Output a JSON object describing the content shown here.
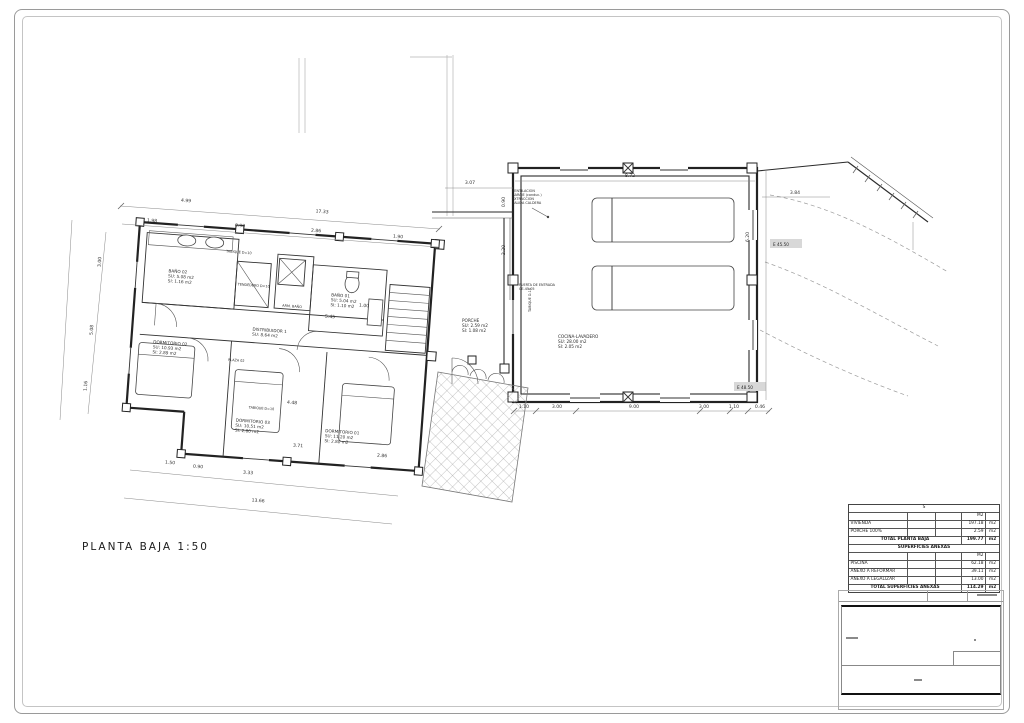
{
  "page": {
    "plan_title": "PLANTA BAJA  1:50"
  },
  "plan": {
    "rooms": {
      "bano02": {
        "name": "BAÑO 02",
        "l1": "SU: 5.08 m2",
        "l2": "SI: 1.16 m2"
      },
      "bano01": {
        "name": "BAÑO 01",
        "l1": "SU: 5.04 m2",
        "l2": "SI: 1.10 m2"
      },
      "distribuidor": {
        "name": "DISTRIBUIDOR 1",
        "l1": "SU: 8.64 m2",
        "l2": ""
      },
      "dorm02": {
        "name": "DORMITORIO 02",
        "l1": "SU: 10.93 m2",
        "l2": "SI: 2.89 m2"
      },
      "dorm03": {
        "name": "DORMITORIO 03",
        "l1": "SU: 10.51 m2",
        "l2": "SI: 2.80 m2"
      },
      "dorm01": {
        "name": "DORMITORIO 01",
        "l1": "SU: 11.20 m2",
        "l2": "SI: 2.80 m2"
      },
      "cocina": {
        "name": "COCINA-LAVADERO",
        "l1": "SU: 28.00 m2",
        "l2": "SI: 2.05 m2"
      },
      "porche": {
        "name": "PORCHE",
        "l1": "SU: 2.59 m2",
        "l2": "SI: 1.08 m2"
      }
    },
    "notes": {
      "plaza": "PLAZA 02",
      "tendedero": "TENDEDERO D=10",
      "tabique_a": "TABIQUE D=10",
      "tabique_b": "TABIQUE D=10",
      "tabique_c": "TABIQUE D-10",
      "armario": "ARM. BAÑO",
      "ventilacion": [
        "VENTILACION",
        "GARAJE (conduc.)",
        "EXTRACCION",
        "SALIDA CALDERA"
      ],
      "puerta": [
        "PUERTA DE ENTRADA",
        "CE-45-05"
      ],
      "elev_a": "E 45.50",
      "elev_b": "E 48.50"
    }
  },
  "dimensions": [
    {
      "t": "4.99",
      "x": 186,
      "y": 202,
      "r": 4
    },
    {
      "t": "17.33",
      "x": 322,
      "y": 213,
      "r": 4
    },
    {
      "t": "1.98",
      "x": 152,
      "y": 222,
      "r": 4
    },
    {
      "t": "0.90",
      "x": 240,
      "y": 227,
      "r": 4
    },
    {
      "t": "2.86",
      "x": 316,
      "y": 232,
      "r": 4
    },
    {
      "t": "1.90",
      "x": 398,
      "y": 238,
      "r": 4
    },
    {
      "t": "3.07",
      "x": 470,
      "y": 184,
      "r": 0
    },
    {
      "t": "8.72",
      "x": 630,
      "y": 177,
      "r": 0
    },
    {
      "t": "3.84",
      "x": 795,
      "y": 194,
      "r": 0
    },
    {
      "t": "6.20",
      "x": 749,
      "y": 237,
      "r": -90
    },
    {
      "t": "1.10",
      "x": 524,
      "y": 408,
      "r": 0
    },
    {
      "t": "3.00",
      "x": 557,
      "y": 408,
      "r": 0
    },
    {
      "t": "9.00",
      "x": 634,
      "y": 408,
      "r": 0
    },
    {
      "t": "3.00",
      "x": 704,
      "y": 408,
      "r": 0
    },
    {
      "t": "1.10",
      "x": 734,
      "y": 408,
      "r": 0
    },
    {
      "t": "0.46",
      "x": 760,
      "y": 408,
      "r": 0
    },
    {
      "t": "0.90",
      "x": 505,
      "y": 202,
      "r": -90
    },
    {
      "t": "2.20",
      "x": 505,
      "y": 250,
      "r": -90
    },
    {
      "t": "3.00",
      "x": 101,
      "y": 262,
      "r": -86
    },
    {
      "t": "5.08",
      "x": 93,
      "y": 330,
      "r": -86
    },
    {
      "t": "1.16",
      "x": 87,
      "y": 386,
      "r": -86
    },
    {
      "t": "5.45",
      "x": 330,
      "y": 318,
      "r": 4
    },
    {
      "t": "1.00",
      "x": 364,
      "y": 307,
      "r": 4
    },
    {
      "t": "4.48",
      "x": 292,
      "y": 404,
      "r": 4
    },
    {
      "t": "3.71",
      "x": 298,
      "y": 447,
      "r": 4
    },
    {
      "t": "2.86",
      "x": 382,
      "y": 457,
      "r": 4
    },
    {
      "t": "1.50",
      "x": 170,
      "y": 464,
      "r": 4
    },
    {
      "t": "0.90",
      "x": 198,
      "y": 468,
      "r": 4
    },
    {
      "t": "3.33",
      "x": 248,
      "y": 474,
      "r": 4
    },
    {
      "t": "13.66",
      "x": 258,
      "y": 502,
      "r": 4
    }
  ],
  "surfaces_table": {
    "header_s": "S",
    "m2": "M2",
    "unit": "m2",
    "rows": {
      "vivienda": {
        "label": "VIVIENDA",
        "value": "197.18"
      },
      "porche": {
        "label": "PORCHE 100%",
        "value": "2.59"
      },
      "total_pb": {
        "label": "TOTAL PLANTA BAJA",
        "value": "199.77"
      },
      "anexas_hdr": "SUPERFICIES ANEXAS",
      "piscina": {
        "label": "PISCINA",
        "value": "62.18"
      },
      "reformar": {
        "label": "ANEXO A REFORMAR",
        "value": "39.11"
      },
      "legalizar": {
        "label": "ANEXO A LEGALIZAR",
        "value": "13.00"
      },
      "total_an": {
        "label": "TOTAL SUPERFICIES ANEXAS",
        "value": "114.29"
      }
    }
  }
}
